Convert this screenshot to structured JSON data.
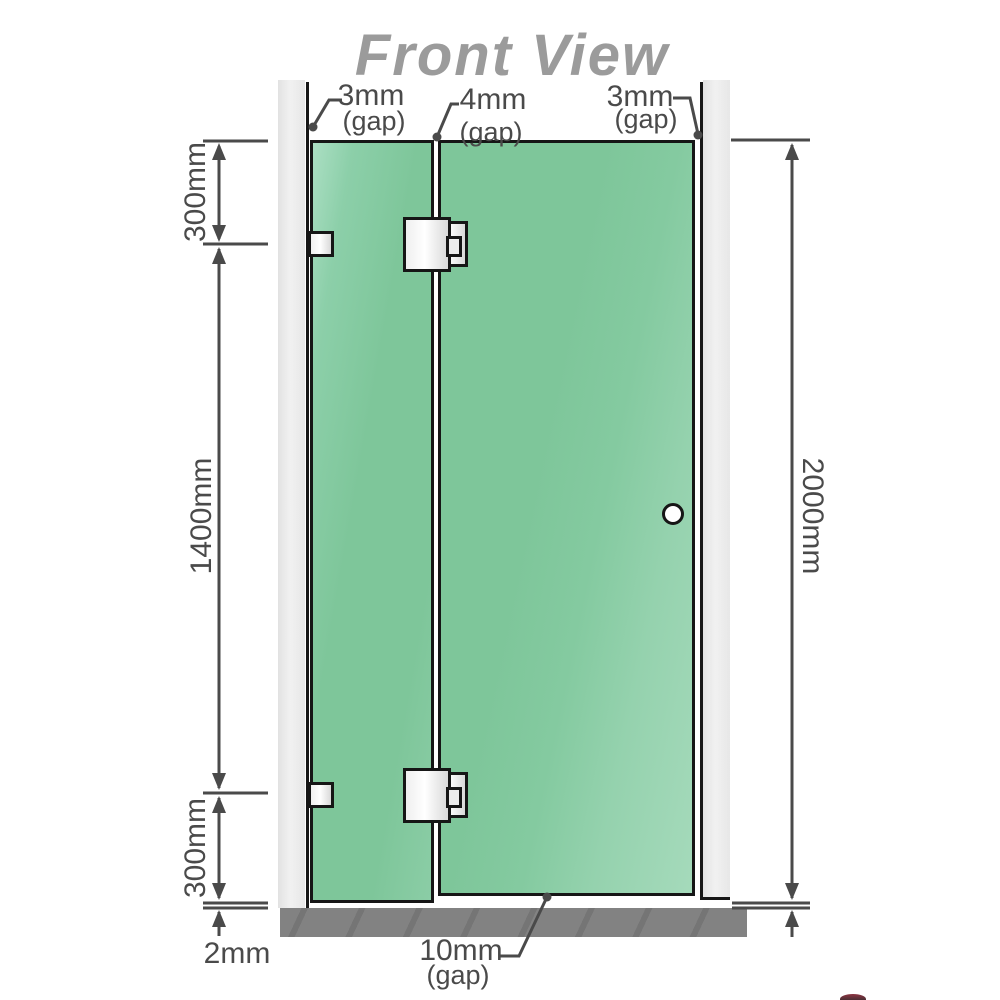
{
  "title": "Front View",
  "gap_labels": {
    "top_left": {
      "value": "3mm",
      "suffix": "(gap)"
    },
    "top_middle": {
      "value": "4mm",
      "suffix": "(gap)"
    },
    "top_right": {
      "value": "3mm",
      "suffix": "(gap)"
    },
    "bottom": {
      "value": "10mm",
      "suffix": "(gap)"
    }
  },
  "dimension_labels": {
    "left_top": "300mm",
    "left_middle": "1400mm",
    "left_bottom": "300mm",
    "bottom_left": "2mm",
    "right": "2000mm"
  },
  "colors": {
    "glass_green": "#7ec69a",
    "glass_highlight": "#a5dabb",
    "wall_gray": "#eaeaea",
    "floor_gray": "#828282",
    "dimension_gray": "#4a4a4a",
    "title_gray": "#9b9b9b",
    "hardware_outline": "#161616"
  }
}
